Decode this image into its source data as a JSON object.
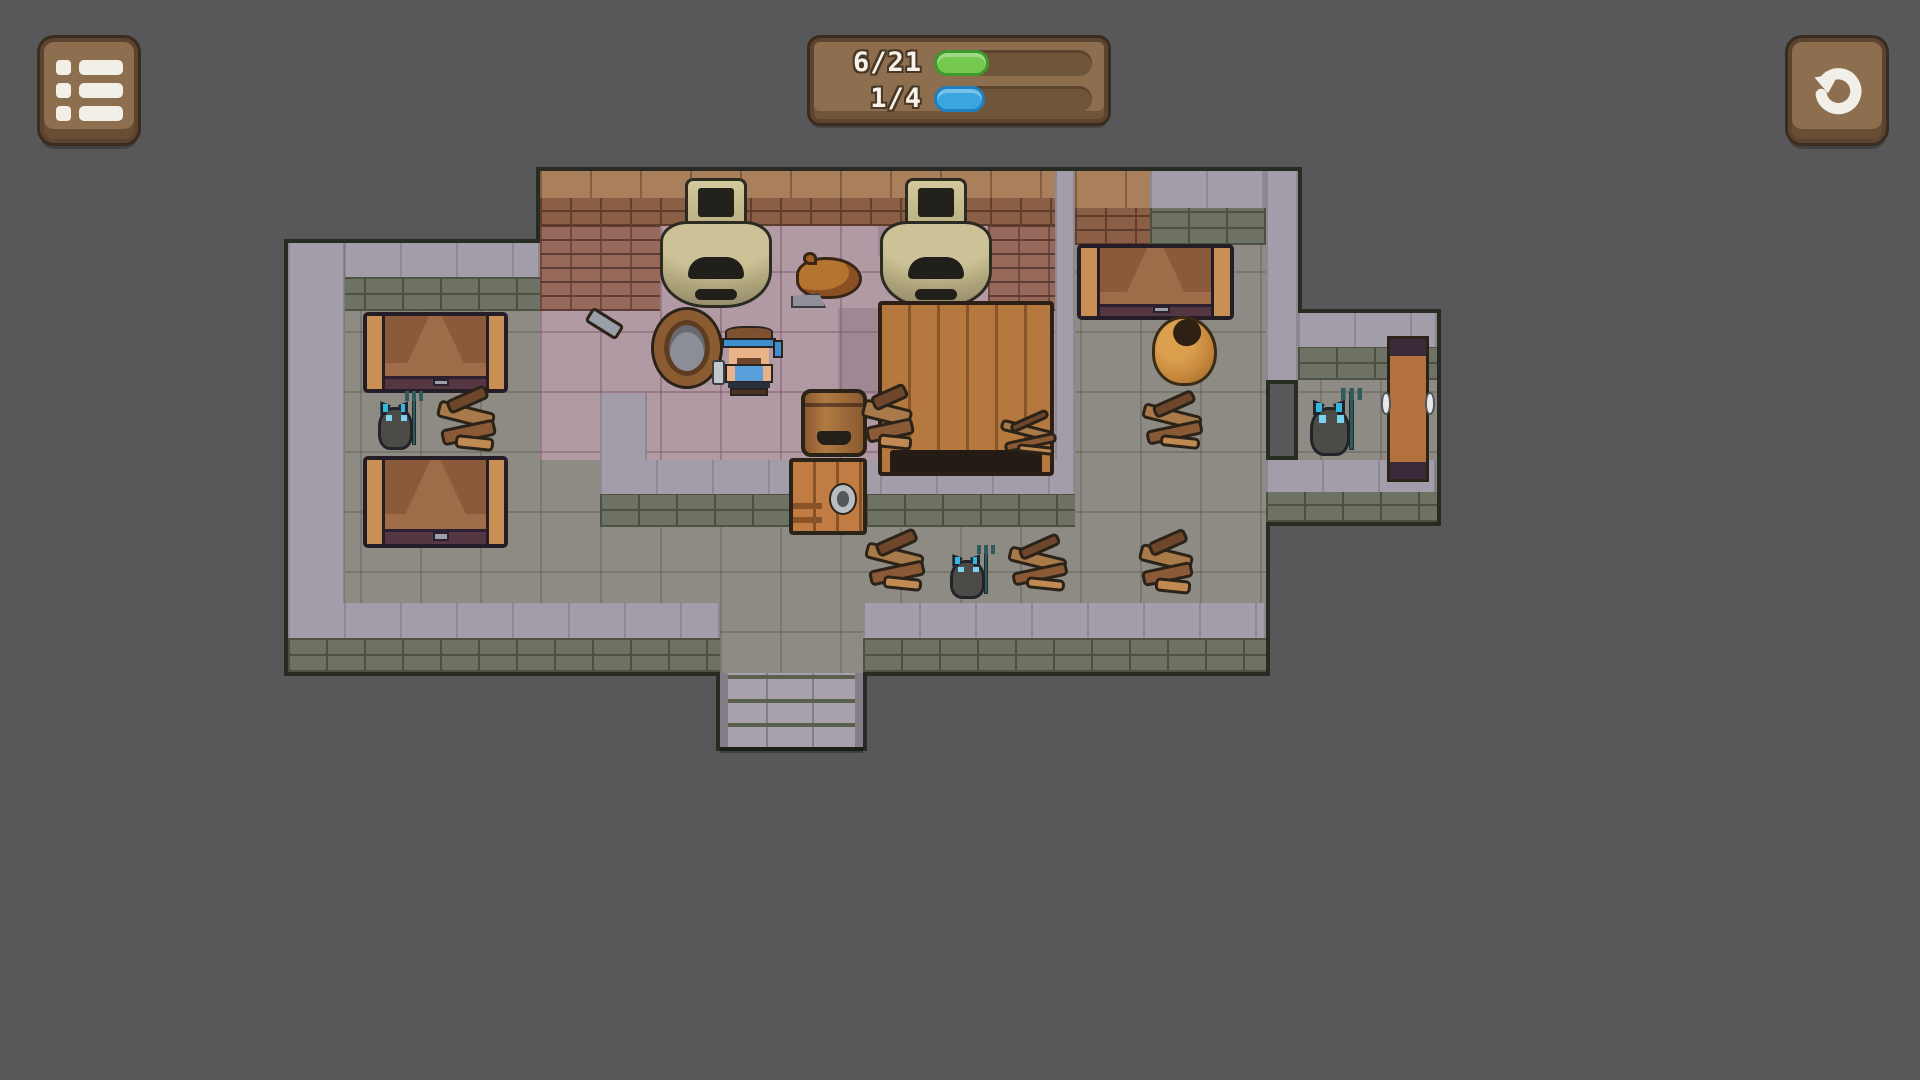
{
  "app": {
    "background": "#58585a"
  },
  "hud": {
    "menu_button": {
      "x": 40,
      "y": 38,
      "w": 90,
      "h": 97,
      "icon": "menu-list-icon"
    },
    "restart_button": {
      "x": 1788,
      "y": 38,
      "w": 90,
      "h": 97,
      "icon": "restart-icon"
    },
    "panel": {
      "x": 810,
      "y": 38,
      "w": 298,
      "h": 85,
      "counters": [
        {
          "label": "6/21",
          "fill_pct": 35,
          "color": "#76c94f",
          "border": "#3f9a2e"
        },
        {
          "label": "1/4",
          "fill_pct": 32,
          "color": "#3aa6e0",
          "border": "#1f7fc2"
        }
      ]
    }
  },
  "colors": {
    "background": "#58585a",
    "stone_floor": "#8d8b84",
    "kitchen_floor": "#b29aa4",
    "wall_top": "#a39daa",
    "wall_face": "#6e7264",
    "brick_top": "#aa7f5c",
    "brick_face": "#8a5f46",
    "wood_panel": "#8d6e4e",
    "counter_green": "#76c94f",
    "counter_blue": "#3aa6e0",
    "rat_eye": "#35b6dd"
  },
  "map": {
    "tile_size": 60,
    "rects": [
      {
        "t": "fp",
        "n": "kitchen-floor",
        "x": 540,
        "y": 226,
        "w": 515,
        "h": 234
      },
      {
        "t": "fg",
        "n": "stone-floor",
        "x": 345,
        "y": 311,
        "w": 195,
        "h": 292
      },
      {
        "t": "fg",
        "n": "stone-floor",
        "x": 540,
        "y": 460,
        "w": 60,
        "h": 143
      },
      {
        "t": "fg",
        "n": "stone-floor",
        "x": 600,
        "y": 527,
        "w": 666,
        "h": 76
      },
      {
        "t": "fg",
        "n": "stone-floor",
        "x": 1075,
        "y": 245,
        "w": 191,
        "h": 215
      },
      {
        "t": "fg",
        "n": "stone-floor",
        "x": 1075,
        "y": 460,
        "w": 125,
        "h": 67
      },
      {
        "t": "fg",
        "n": "stone-floor",
        "x": 1200,
        "y": 460,
        "w": 66,
        "h": 143
      },
      {
        "t": "fg",
        "n": "stone-floor",
        "x": 1298,
        "y": 380,
        "w": 139,
        "h": 80
      },
      {
        "t": "fg",
        "n": "stone-floor",
        "x": 720,
        "y": 603,
        "w": 143,
        "h": 70
      },
      {
        "t": "fpd",
        "n": "kitchen-floor-dark-tile",
        "x": 838,
        "y": 308,
        "w": 40,
        "h": 86
      },
      {
        "t": "fpd",
        "n": "kitchen-floor-dark-tile",
        "x": 878,
        "y": 226,
        "w": 60,
        "h": 30
      },
      {
        "t": "wtb",
        "n": "brick-wall",
        "x": 540,
        "y": 171,
        "w": 515,
        "h": 27
      },
      {
        "t": "wfb",
        "n": "brick-wall",
        "x": 540,
        "y": 198,
        "w": 515,
        "h": 28
      },
      {
        "t": "wfp",
        "n": "brick-wall",
        "x": 540,
        "y": 226,
        "w": 120,
        "h": 85
      },
      {
        "t": "wfp",
        "n": "brick-wall",
        "x": 988,
        "y": 226,
        "w": 67,
        "h": 85
      },
      {
        "t": "wtg",
        "n": "stone-wall",
        "x": 1055,
        "y": 171,
        "w": 20,
        "h": 289
      },
      {
        "t": "wtb",
        "n": "brick-wall",
        "x": 1075,
        "y": 171,
        "w": 75,
        "h": 37
      },
      {
        "t": "wfb",
        "n": "brick-wall",
        "x": 1075,
        "y": 208,
        "w": 75,
        "h": 37
      },
      {
        "t": "wtg",
        "n": "stone-wall",
        "x": 1150,
        "y": 171,
        "w": 116,
        "h": 37
      },
      {
        "t": "wfg",
        "n": "stone-wall",
        "x": 1150,
        "y": 208,
        "w": 116,
        "h": 37
      },
      {
        "t": "wtg",
        "n": "stone-wall",
        "x": 1266,
        "y": 171,
        "w": 32,
        "h": 209
      },
      {
        "t": "wtg",
        "n": "stone-wall",
        "x": 1298,
        "y": 313,
        "w": 139,
        "h": 34
      },
      {
        "t": "wfg",
        "n": "stone-wall",
        "x": 1298,
        "y": 347,
        "w": 139,
        "h": 33
      },
      {
        "t": "wtg",
        "n": "stone-wall",
        "x": 288,
        "y": 243,
        "w": 252,
        "h": 34
      },
      {
        "t": "wfg",
        "n": "stone-wall",
        "x": 288,
        "y": 277,
        "w": 252,
        "h": 34
      },
      {
        "t": "wtg",
        "n": "stone-wall",
        "x": 288,
        "y": 243,
        "w": 57,
        "h": 360
      },
      {
        "t": "wtg",
        "n": "stone-wall",
        "x": 600,
        "y": 393,
        "w": 47,
        "h": 67
      },
      {
        "t": "wtg",
        "n": "stone-wall",
        "x": 600,
        "y": 460,
        "w": 475,
        "h": 34
      },
      {
        "t": "wfg",
        "n": "stone-wall",
        "x": 600,
        "y": 494,
        "w": 475,
        "h": 33
      },
      {
        "t": "wtg",
        "n": "stone-wall",
        "x": 1266,
        "y": 460,
        "w": 171,
        "h": 32
      },
      {
        "t": "wfg",
        "n": "stone-wall",
        "x": 1266,
        "y": 492,
        "w": 171,
        "h": 30
      },
      {
        "t": "wtg",
        "n": "stone-wall",
        "x": 288,
        "y": 603,
        "w": 432,
        "h": 35
      },
      {
        "t": "wfg",
        "n": "stone-wall",
        "x": 288,
        "y": 638,
        "w": 432,
        "h": 34
      },
      {
        "t": "wtg",
        "n": "stone-wall",
        "x": 863,
        "y": 603,
        "w": 403,
        "h": 35
      },
      {
        "t": "wfg",
        "n": "stone-wall",
        "x": 863,
        "y": 638,
        "w": 403,
        "h": 34
      },
      {
        "t": "steps",
        "n": "stairs-exit",
        "x": 720,
        "y": 673,
        "w": 143,
        "h": 74
      }
    ],
    "sprites": [
      {
        "t": "kiln",
        "x": 660,
        "y": 178,
        "w": 112,
        "h": 130
      },
      {
        "t": "kiln",
        "x": 880,
        "y": 178,
        "w": 112,
        "h": 130
      },
      {
        "t": "pig",
        "x": 791,
        "y": 251,
        "w": 76,
        "h": 57
      },
      {
        "t": "sled",
        "x": 538,
        "y": 298,
        "w": 92,
        "h": 94
      },
      {
        "t": "well",
        "x": 654,
        "y": 310,
        "w": 66,
        "h": 76
      },
      {
        "t": "tbl",
        "x": 878,
        "y": 301,
        "w": 168,
        "h": 167
      },
      {
        "t": "brl",
        "x": 801,
        "y": 389,
        "w": 58,
        "h": 60
      },
      {
        "t": "door",
        "x": 789,
        "y": 458,
        "w": 70,
        "h": 69
      },
      {
        "t": "deb",
        "x": 860,
        "y": 385,
        "w": 60,
        "h": 72
      },
      {
        "t": "deb",
        "x": 997,
        "y": 413,
        "w": 66,
        "h": 46
      },
      {
        "t": "bed",
        "x": 363,
        "y": 312,
        "w": 137,
        "h": 73
      },
      {
        "t": "bed",
        "x": 363,
        "y": 456,
        "w": 137,
        "h": 84
      },
      {
        "t": "bed",
        "x": 1077,
        "y": 244,
        "w": 149,
        "h": 68
      },
      {
        "t": "rat",
        "x": 372,
        "y": 391,
        "w": 52,
        "h": 63
      },
      {
        "t": "deb",
        "x": 434,
        "y": 388,
        "w": 69,
        "h": 69
      },
      {
        "t": "pot",
        "x": 1149,
        "y": 311,
        "w": 71,
        "h": 78
      },
      {
        "t": "deb",
        "x": 1139,
        "y": 393,
        "w": 71,
        "h": 62
      },
      {
        "t": "deb",
        "x": 862,
        "y": 531,
        "w": 70,
        "h": 66
      },
      {
        "t": "rat",
        "x": 944,
        "y": 545,
        "w": 52,
        "h": 57
      },
      {
        "t": "deb",
        "x": 1005,
        "y": 536,
        "w": 70,
        "h": 60
      },
      {
        "t": "deb",
        "x": 1136,
        "y": 531,
        "w": 64,
        "h": 68
      },
      {
        "t": "rat",
        "x": 1303,
        "y": 388,
        "w": 60,
        "h": 72
      },
      {
        "t": "pdoor",
        "x": 1387,
        "y": 336,
        "w": 36,
        "h": 140
      },
      {
        "t": "pl",
        "x": 720,
        "y": 326,
        "w": 58,
        "h": 70
      }
    ]
  }
}
